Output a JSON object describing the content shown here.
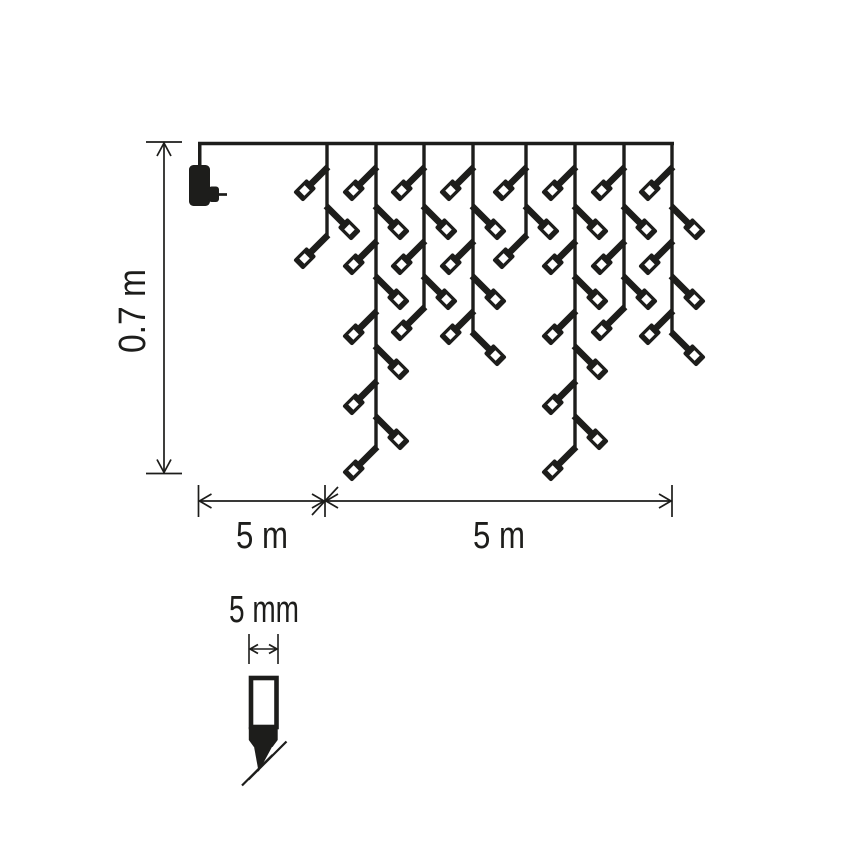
{
  "page": {
    "background": "#ffffff",
    "width": 868,
    "height": 868
  },
  "colors": {
    "ink": "#1d1d1b",
    "paper": "#ffffff"
  },
  "labels": {
    "drop_height": "0.7 m",
    "lead_length": "5 m",
    "lit_length": "5 m",
    "bulb_width": "5 mm"
  },
  "diagram": {
    "type": "technical-dimension-diagram",
    "subject": "icicle-light-chain-with-plug-and-led-detail",
    "wire": {
      "x1": 198,
      "x2": 674,
      "y": 143.5
    },
    "plug": {
      "cord_x": 199.75,
      "cord_bottom": 166,
      "body": {
        "x": 189,
        "y": 165,
        "w": 21,
        "h": 41,
        "r": 4.5
      },
      "tab": {
        "x": 208.5,
        "y": 186.5,
        "w": 10.5,
        "h": 15.5,
        "r": 3
      },
      "pin": {
        "x1": 219,
        "x2": 227,
        "y": 194.5
      }
    },
    "drops": [
      {
        "x": 327,
        "bottom": 236,
        "leds": [
          {
            "y": 168,
            "side": "L"
          },
          {
            "y": 207,
            "side": "R"
          },
          {
            "y": 236,
            "side": "L"
          }
        ]
      },
      {
        "x": 376,
        "bottom": 448,
        "leds": [
          {
            "y": 168,
            "side": "L"
          },
          {
            "y": 207,
            "side": "R"
          },
          {
            "y": 242,
            "side": "L"
          },
          {
            "y": 277,
            "side": "R"
          },
          {
            "y": 312,
            "side": "L"
          },
          {
            "y": 347,
            "side": "R"
          },
          {
            "y": 382,
            "side": "L"
          },
          {
            "y": 417,
            "side": "R"
          },
          {
            "y": 448,
            "side": "L"
          }
        ]
      },
      {
        "x": 424,
        "bottom": 308,
        "leds": [
          {
            "y": 168,
            "side": "L"
          },
          {
            "y": 207,
            "side": "R"
          },
          {
            "y": 242,
            "side": "L"
          },
          {
            "y": 277,
            "side": "R"
          },
          {
            "y": 308,
            "side": "L"
          }
        ]
      },
      {
        "x": 473,
        "bottom": 333,
        "leds": [
          {
            "y": 168,
            "side": "L"
          },
          {
            "y": 207,
            "side": "R"
          },
          {
            "y": 242,
            "side": "L"
          },
          {
            "y": 277,
            "side": "R"
          },
          {
            "y": 312,
            "side": "L"
          },
          {
            "y": 333,
            "side": "R"
          }
        ]
      },
      {
        "x": 526,
        "bottom": 236,
        "leds": [
          {
            "y": 168,
            "side": "L"
          },
          {
            "y": 207,
            "side": "R"
          },
          {
            "y": 236,
            "side": "L"
          }
        ]
      },
      {
        "x": 575,
        "bottom": 448,
        "leds": [
          {
            "y": 168,
            "side": "L"
          },
          {
            "y": 207,
            "side": "R"
          },
          {
            "y": 242,
            "side": "L"
          },
          {
            "y": 277,
            "side": "R"
          },
          {
            "y": 312,
            "side": "L"
          },
          {
            "y": 347,
            "side": "R"
          },
          {
            "y": 382,
            "side": "L"
          },
          {
            "y": 417,
            "side": "R"
          },
          {
            "y": 448,
            "side": "L"
          }
        ]
      },
      {
        "x": 624,
        "bottom": 308,
        "leds": [
          {
            "y": 168,
            "side": "L"
          },
          {
            "y": 207,
            "side": "R"
          },
          {
            "y": 242,
            "side": "L"
          },
          {
            "y": 277,
            "side": "R"
          },
          {
            "y": 308,
            "side": "L"
          }
        ]
      },
      {
        "x": 672,
        "bottom": 333,
        "leds": [
          {
            "y": 168,
            "side": "L"
          },
          {
            "y": 207,
            "side": "R"
          },
          {
            "y": 242,
            "side": "L"
          },
          {
            "y": 277,
            "side": "R"
          },
          {
            "y": 312,
            "side": "L"
          },
          {
            "y": 333,
            "side": "R"
          }
        ]
      }
    ],
    "height_dimension": {
      "x": 164,
      "y1": 142,
      "y2": 473.5,
      "crossbar_half": 18,
      "label_x": 145,
      "label_y": 311
    },
    "bottom_dimension": {
      "y": 501,
      "x1": 198.5,
      "mid": 325,
      "x2": 672,
      "tick_y1": 485,
      "tick_y2": 517,
      "label1_x": 262,
      "label2_x": 499,
      "label_y": 548
    },
    "bulb_dimension": {
      "y": 649,
      "x1": 249,
      "x2": 278,
      "tick_y1": 634,
      "tick_y2": 664,
      "label_x": 264,
      "label_y": 622
    },
    "bulb_detail": {
      "outer": {
        "x": 251,
        "y": 678,
        "w": 25.5,
        "h": 49,
        "stroke": 4.6
      },
      "neck": [
        [
          248.8,
          727
        ],
        [
          277.7,
          727
        ],
        [
          277.7,
          740
        ],
        [
          272.5,
          747
        ],
        [
          253.9,
          747
        ],
        [
          248.8,
          740
        ]
      ],
      "tip": [
        [
          253.9,
          746
        ],
        [
          272.5,
          746
        ],
        [
          258.6,
          771.8
        ]
      ],
      "slashes": [
        [
          248.5,
          779.5,
          286.5,
          741.5
        ],
        [
          242,
          785.5,
          272.5,
          755
        ]
      ]
    }
  }
}
